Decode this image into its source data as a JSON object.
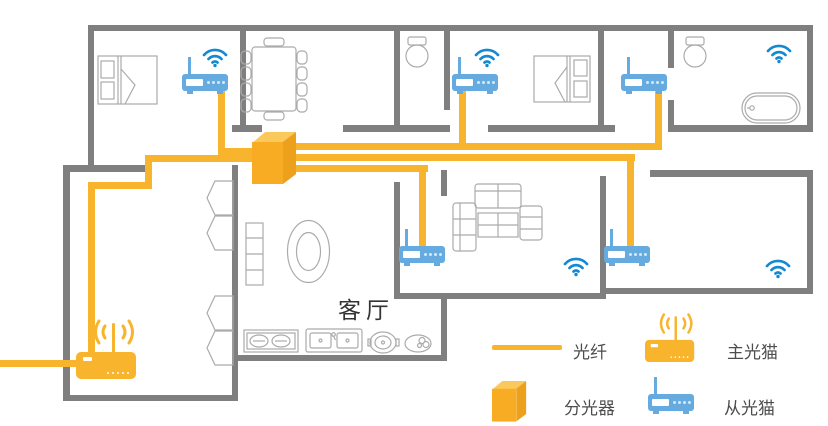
{
  "floor_plan": {
    "room_label": "客厅"
  },
  "legend": {
    "items": [
      {
        "id": "fiber",
        "label": "光纤"
      },
      {
        "id": "splitter",
        "label": "分光器"
      },
      {
        "id": "main_modem",
        "label": "主光猫"
      },
      {
        "id": "slave_modem",
        "label": "从光猫"
      }
    ]
  },
  "devices": {
    "main_modem_count": 1,
    "splitter_count": 1,
    "slave_modem_count": 5,
    "wifi_coverage_count": 5
  },
  "colors": {
    "fiber_yellow": "#F8B42C",
    "splitter_front": "#F7AC23",
    "splitter_top": "#FBC95B",
    "splitter_side": "#EDA01C",
    "router_blue": "#66ABDF",
    "wifi_blue": "#1489D3",
    "wall_gray": "#7F7F7F",
    "furniture_gray": "#ABABAB",
    "label_text": "#4D4D4D"
  }
}
